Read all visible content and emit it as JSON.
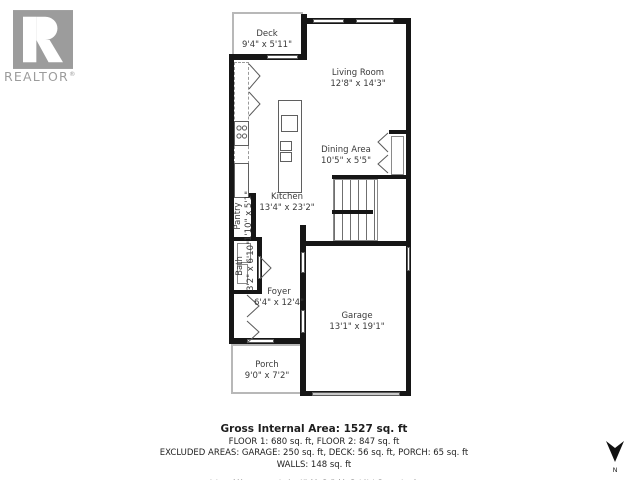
{
  "branding": {
    "logo_icon": "realtor-block-r",
    "logo_text": "REALTOR",
    "registered_mark": "®"
  },
  "floorplan": {
    "wall_color": "#161616",
    "thin_wall_color": "#b8b8b8",
    "rooms": [
      {
        "name": "Deck",
        "dims": "9'4\" x 5'11\""
      },
      {
        "name": "Living Room",
        "dims": "12'8\" x 14'3\""
      },
      {
        "name": "Dining Area",
        "dims": "10'5\" x 5'5\""
      },
      {
        "name": "Kitchen",
        "dims": "13'4\" x 23'2\""
      },
      {
        "name": "Pantry",
        "dims": "1'10\" x 5'1\""
      },
      {
        "name": "Bath",
        "dims": "3'2\" x 6'10\""
      },
      {
        "name": "Foyer",
        "dims": "6'4\" x 12'4\""
      },
      {
        "name": "Garage",
        "dims": "13'1\" x 19'1\""
      },
      {
        "name": "Porch",
        "dims": "9'0\" x 7'2\""
      }
    ]
  },
  "summary": {
    "title": "Gross Internal Area: 1527 sq. ft",
    "floors": "FLOOR 1: 680 sq. ft, FLOOR 2: 847 sq. ft",
    "excluded": "EXCLUDED AREAS: GARAGE: 250 sq. ft, DECK: 56 sq. ft, PORCH: 65 sq. ft",
    "walls": "WALLS: 148 sq. ft",
    "disclaimer": "Internal Measurements Are Highly Reliable But Not Guaranteed."
  },
  "compass": {
    "label": "N"
  }
}
